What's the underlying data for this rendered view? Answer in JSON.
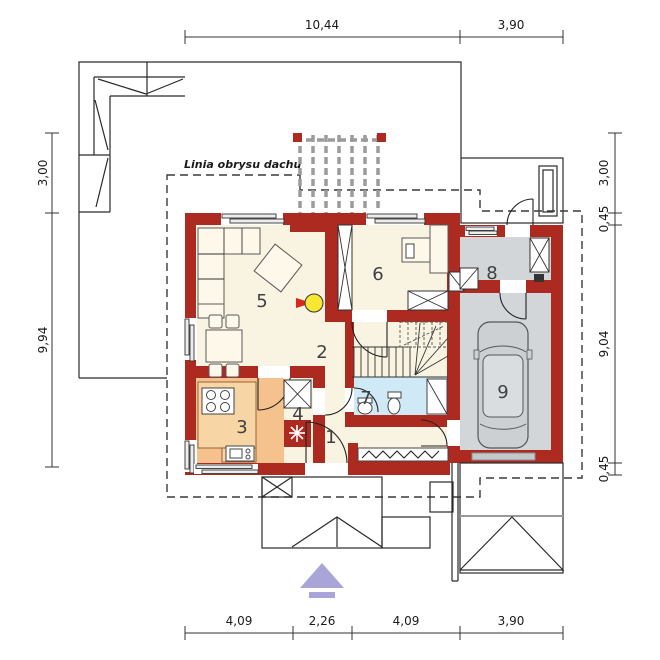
{
  "annotation": {
    "roof_outline_label": "Linia obrysu dachu"
  },
  "rooms": [
    {
      "number": "1"
    },
    {
      "number": "2"
    },
    {
      "number": "3"
    },
    {
      "number": "4"
    },
    {
      "number": "5"
    },
    {
      "number": "6"
    },
    {
      "number": "7"
    },
    {
      "number": "8"
    },
    {
      "number": "9"
    }
  ],
  "dimensions": {
    "top": [
      "10,44",
      "3,90"
    ],
    "bottom": [
      "4,09",
      "2,26",
      "4,09",
      "3,90"
    ],
    "left": [
      "3,00",
      "9,94"
    ],
    "right": [
      "3,00",
      "0,45",
      "9,04",
      "0,45"
    ]
  },
  "colors": {
    "wall": "#ac2a20",
    "floor": "#f9f3e1",
    "kitchen": "#f5c28d",
    "bath": "#cfe9f6",
    "garage": "#d2d6d8",
    "furniture": "#fdf8ea",
    "fireplace": "#f7e733",
    "fireplace_arrow": "#d8281c",
    "entrance_arrow": "#a9a5d8"
  },
  "icons": {
    "fireplace": "fireplace-icon",
    "vent": "snowflake-vent-icon",
    "car": "car-top-view-icon",
    "entrance": "entrance-arrow-icon",
    "chimney": "chimney-x-icon"
  }
}
